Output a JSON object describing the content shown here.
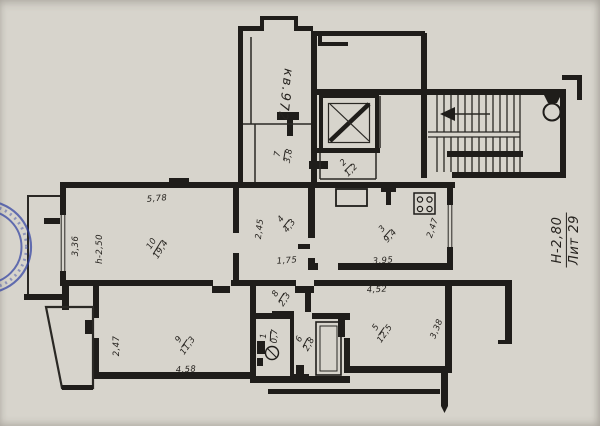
{
  "colors": {
    "paper": "#d7d4cc",
    "ink": "#1f1d1a",
    "stamp_blue": "#2e3fa2"
  },
  "annotations": {
    "apartment_number": "кв.972",
    "liter": "Лит 29",
    "floor_height": "Н-2,80",
    "room_height": "h-2,50"
  },
  "rooms": {
    "r1": {
      "number": "1",
      "area": "0,7"
    },
    "r2": {
      "number": "2",
      "area": "1,2"
    },
    "r3": {
      "number": "3",
      "area": "9,4"
    },
    "r4": {
      "number": "4",
      "area": "4,3"
    },
    "r5": {
      "number": "5",
      "area": "12,5"
    },
    "r6": {
      "number": "6",
      "area": "2,8"
    },
    "r7": {
      "number": "7",
      "area": "3,8"
    },
    "r8": {
      "number": "8",
      "area": "2,3"
    },
    "r9": {
      "number": "9",
      "area": "11,3"
    },
    "r10": {
      "number": "10",
      "area": "19,4"
    }
  },
  "dims": {
    "room10_top": "5,78",
    "room10_left": "3,36",
    "room4_left": "2,45",
    "room4_bottom": "1,75",
    "kitchen_bottom": "3,95",
    "kitchen_right": "2,47",
    "room5_top": "4,52",
    "room5_right": "3,38",
    "room9_left": "2,47",
    "room9_bottom": "4,58"
  }
}
